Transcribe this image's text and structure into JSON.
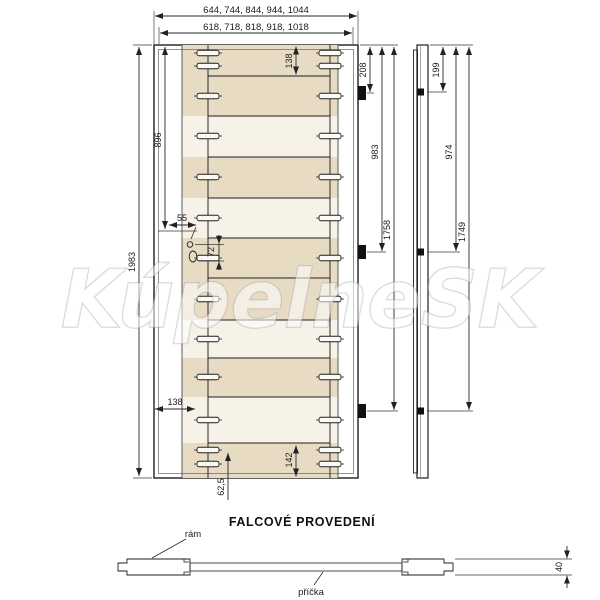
{
  "watermark": {
    "text": "KúpelneSK"
  },
  "title": "FALCOVÉ PROVEDENÍ",
  "front_view": {
    "width_outer": "644, 744, 844, 944, 1044",
    "width_inner": "618, 718, 818, 918, 1018",
    "height_total": "1983",
    "handle_height": "896",
    "top_rail": "138",
    "bottom_rail": "142",
    "bottom_slot_inset": "138",
    "bottom_slot_offset": "62,5",
    "lock_edge_offset": "55",
    "lock_spacing": "72",
    "hinge_top": "208",
    "hinge_middle": "983",
    "hinge_bottom": "1758"
  },
  "edge_view": {
    "hinge_top": "199",
    "hinge_middle": "974",
    "hinge_bottom": "1749"
  },
  "section_view": {
    "frame_label": "rám",
    "rail_label": "příčka",
    "thickness": "40"
  },
  "colors": {
    "wood_light": "#e7dbc4",
    "wood_pale": "#f7f2e8",
    "wood_dark": "#d9c6ab",
    "slot_fill": "#fbf9f4",
    "line": "#1f1f1f"
  }
}
